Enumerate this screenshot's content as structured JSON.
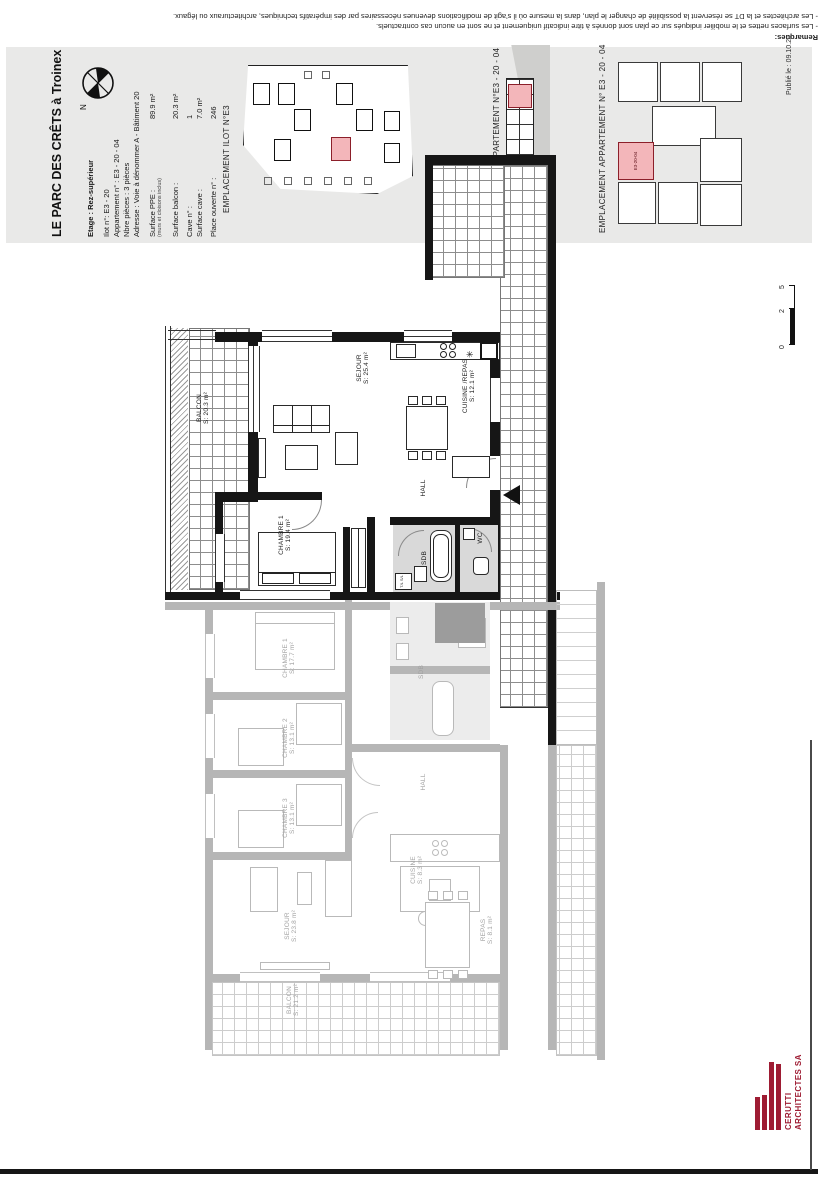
{
  "remarks": {
    "title": "Remarques:",
    "line1": "- Les surfaces nettes et le mobilier indiqués sur ce plan sont donnés à titre indicatif uniquement et ne sont en aucun cas contractuels.",
    "line2": "- Les architectes et la DT se réservent la possibilité de changer le plan, dans la mesure où il s'agit de modifications devenues nécessaires par des impératifs techniques, architecturaux ou légaux."
  },
  "title_block": {
    "project": "LE PARC DES CRÊTS à Troinex",
    "etage": "Etage : Rez-supérieur",
    "north": "N",
    "ppe_note": "(murs et cloisons inclus)",
    "rows": [
      {
        "label": "Ilot n°:",
        "value": "E3 - 20"
      },
      {
        "label": "Appartement n° :",
        "value": "E3 - 20 - 04"
      },
      {
        "label": "Nbre pièces :",
        "value": "3 pièces"
      },
      {
        "label": "Adresse :",
        "value": "Voie à dénommer A - Bâtiment 20"
      },
      {
        "label": "Surface PPE :",
        "value": "89.9 m²"
      },
      {
        "label": "Surface balcon :",
        "value": "20.3 m²"
      },
      {
        "label": "Cave n° :",
        "value": "1"
      },
      {
        "label": "Surface cave :",
        "value": "7.0 m²"
      },
      {
        "label": "Place ouverte n° :",
        "value": "246"
      }
    ]
  },
  "panels": {
    "ilot_label": "EMPLACEMENT ILOT N°E3",
    "coupe_label": "COUPE SUR APPARTEMENT N°E3 - 20 - 04",
    "apart_label": "EMPLACEMENT APPARTEMENT N° E3 - 20 - 04",
    "published": "Publié le : 09.10.20",
    "unit_code": "E3-20-04"
  },
  "plan": {
    "active": {
      "balcon": {
        "name": "BALCON",
        "area": "S: 20.3 m²"
      },
      "sejour": {
        "name": "SEJOUR",
        "area": "S: 25.4 m²"
      },
      "cuisine": {
        "name": "CUISINE /REPAS",
        "area": "S: 12.1 m²"
      },
      "chambre1": {
        "name": "CHAMBRE 1",
        "area": "S: 19.4 m²"
      },
      "hall": "HALL",
      "sdb": "SDB",
      "wc": "WC",
      "washer": "T/L S/L"
    },
    "ghost": {
      "chambre1": {
        "name": "CHAMBRE 1",
        "area": "S: 17.7 m²"
      },
      "chambre2": {
        "name": "CHAMBRE 2",
        "area": "S: 13.1 m²"
      },
      "chambre3": {
        "name": "CHAMBRE 3",
        "area": "S: 13.1 m²"
      },
      "sejour": {
        "name": "SEJOUR",
        "area": "S: 23.8 m²"
      },
      "cuisine": {
        "name": "CUISINE",
        "area": "S: 8.3 m²"
      },
      "repas": {
        "name": "REPAS",
        "area": "S: 8.1 m²"
      },
      "balcon": {
        "name": "BALCON",
        "area": "S: 21.2 m²"
      },
      "hall": "HALL",
      "sdb": "SDB"
    }
  },
  "scale_bar": {
    "m0": "0",
    "m2": "2",
    "m5": "5"
  },
  "logo": {
    "line1": "CERUTTI",
    "line2": "ARCHITECTES SA"
  },
  "icons": {
    "dishwasher": "✳"
  },
  "colors": {
    "highlight": "#f3b6ba",
    "logo_red": "#9e1c33",
    "band_bg": "#e9e9e8"
  }
}
